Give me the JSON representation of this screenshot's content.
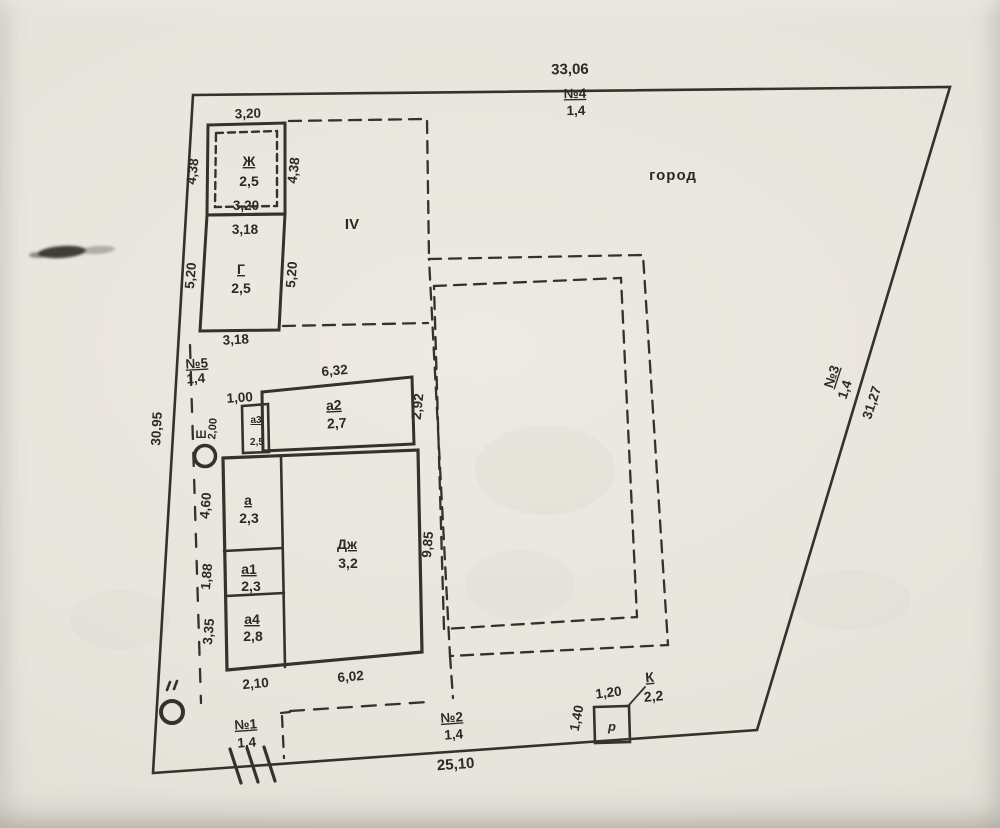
{
  "plan": {
    "region_label": "город",
    "zone_label": "IV",
    "boundaries": {
      "north": {
        "length": "33,06",
        "ref": "№4",
        "height": "1,4"
      },
      "east": {
        "ref": "№3",
        "height": "1,4",
        "length": "31,27"
      },
      "west": {
        "length": "30,95",
        "ref": "№5",
        "height": "1,4"
      },
      "south1": {
        "ref": "№1",
        "height": "1,4"
      },
      "south2": {
        "ref": "№2",
        "height": "1,4"
      },
      "south_length": "25,10"
    },
    "structures": {
      "zh": {
        "label": "Ж",
        "mark": "2,5",
        "top": "3,20",
        "bottom": "3,20",
        "left": "4,38",
        "right": "4,38"
      },
      "g": {
        "label": "Г",
        "mark": "2,5",
        "top": "3,18",
        "bottom": "3,18",
        "left": "5,20",
        "right": "5,20"
      },
      "a2": {
        "label": "а2",
        "mark": "2,7",
        "top": "6,32",
        "offset": "1,00",
        "right": "2,92"
      },
      "a3": {
        "label": "а3",
        "mark": "2,5",
        "left": "2,00"
      },
      "a": {
        "label": "а",
        "mark": "2,3",
        "left": "4,60"
      },
      "a1": {
        "label": "а1",
        "mark": "2,3",
        "left": "1,88"
      },
      "a4": {
        "label": "а4",
        "mark": "2,8",
        "left": "3,35"
      },
      "dzh": {
        "label": "Дж",
        "mark": "3,2",
        "right": "9,85",
        "bottom": "6,02",
        "bottom_offset": "2,10"
      },
      "k": {
        "label": "К",
        "mark": "2,2",
        "top": "1,20",
        "left": "1,40",
        "symbol": "р"
      }
    },
    "markers": {
      "well_label": "Ш"
    }
  }
}
